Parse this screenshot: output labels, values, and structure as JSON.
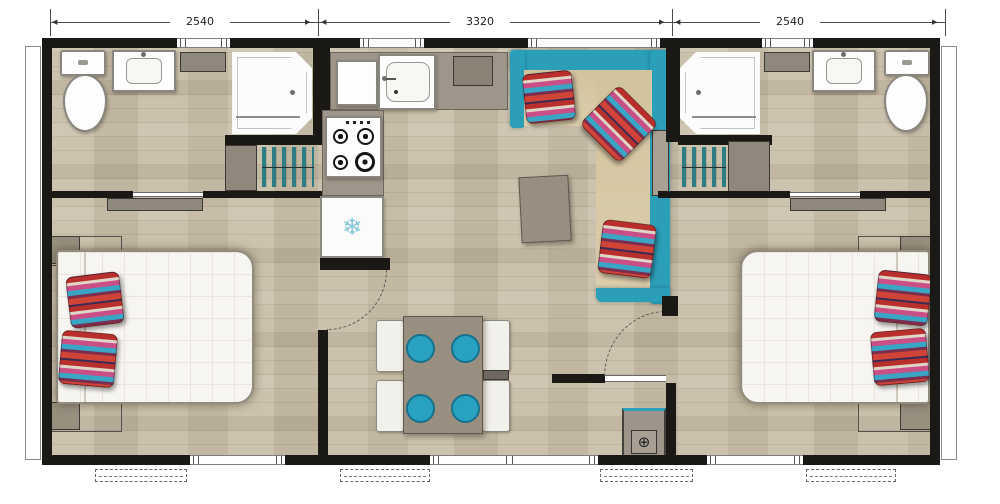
{
  "dimension_labels": {
    "left": "2540",
    "center": "3320",
    "right": "2540"
  },
  "arrows": {
    "left": "◀",
    "right": "▶"
  },
  "icons": {
    "fridge_snowflake": "❄",
    "utility_valve": "⊕"
  },
  "colors": {
    "wall": "#1b1916",
    "floor_wood": "#c9bfa9",
    "accent_teal": "#2b9fb8",
    "seat_teal": "#29a2c2",
    "sofa_cushion_beige": "#d9cba6",
    "counter_gray": "#9e968a",
    "bed_white": "#f7f5f1",
    "pillow_red": "#b92f2c",
    "pillow_blue": "#39a6c6",
    "pillow_pink": "#c94f86"
  }
}
